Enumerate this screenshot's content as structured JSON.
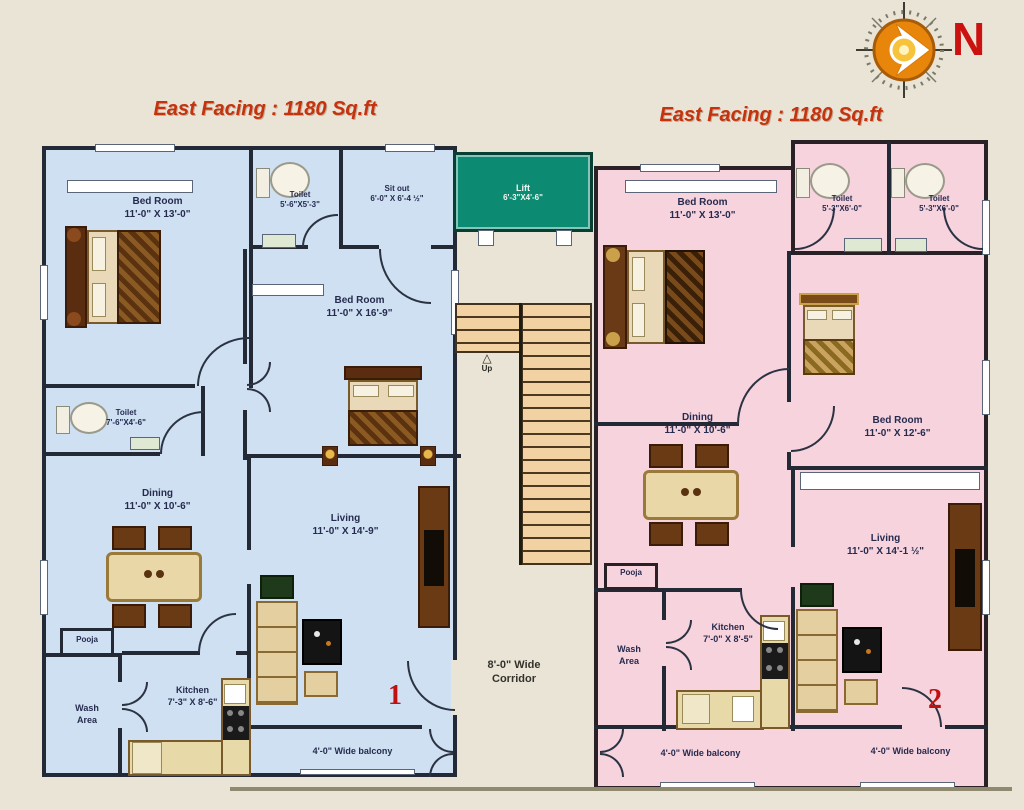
{
  "titles": {
    "left": "East Facing : 1180 Sq.ft",
    "right": "East Facing : 1180 Sq.ft"
  },
  "compass": {
    "north_label": "N"
  },
  "core": {
    "lift_name": "Lift",
    "lift_dim": "6'-3\"X4'-6\"",
    "up_icon": "△",
    "up_label": "Up",
    "corridor_line1": "8'-0\" Wide",
    "corridor_line2": "Corridor"
  },
  "unit1": {
    "number": "1",
    "bedroom1_name": "Bed Room",
    "bedroom1_dim": "11'-0\" X 13'-0\"",
    "toilet1_name": "Toilet",
    "toilet1_dim": "5'-6\"X5'-3\"",
    "sitout_name": "Sit out",
    "sitout_dim": "6'-0\" X 6'-4 ½\"",
    "bedroom2_name": "Bed Room",
    "bedroom2_dim": "11'-0\" X 16'-9\"",
    "toilet2_name": "Toilet",
    "toilet2_dim": "7'-6\"X4'-6\"",
    "dining_name": "Dining",
    "dining_dim": "11'-0\" X 10'-6\"",
    "living_name": "Living",
    "living_dim": "11'-0\" X 14'-9\"",
    "pooja_label": "Pooja",
    "wash_line1": "Wash",
    "wash_line2": "Area",
    "kitchen_name": "Kitchen",
    "kitchen_dim": "7'-3\" X 8'-6\"",
    "balcony_label": "4'-0\" Wide balcony"
  },
  "unit2": {
    "number": "2",
    "bedroom1_name": "Bed Room",
    "bedroom1_dim": "11'-0\" X 13'-0\"",
    "toilet1_name": "Toilet",
    "toilet1_dim": "5'-3\"X6'-0\"",
    "toilet2_name": "Toilet",
    "toilet2_dim": "5'-3\"X6'-0\"",
    "bedroom2_name": "Bed Room",
    "bedroom2_dim": "11'-0\" X 12'-6\"",
    "dining_name": "Dining",
    "dining_dim": "11'-0\" X 10'-6\"",
    "living_name": "Living",
    "living_dim": "11'-0\" X 14'-1 ½\"",
    "pooja_label": "Pooja",
    "wash_line1": "Wash",
    "wash_line2": "Area",
    "kitchen_name": "Kitchen",
    "kitchen_dim": "7'-0\" X 8'-5\"",
    "balcony_label1": "4'-0\" Wide balcony",
    "balcony_label2": "4'-0\" Wide balcony"
  },
  "colors": {
    "unit1_bg": "#cfe0f2",
    "unit2_bg": "#f7d3de",
    "lift_bg": "#0d8b72",
    "wall": "#232a36",
    "title": "#c4330e",
    "accent_number": "#c01010"
  }
}
